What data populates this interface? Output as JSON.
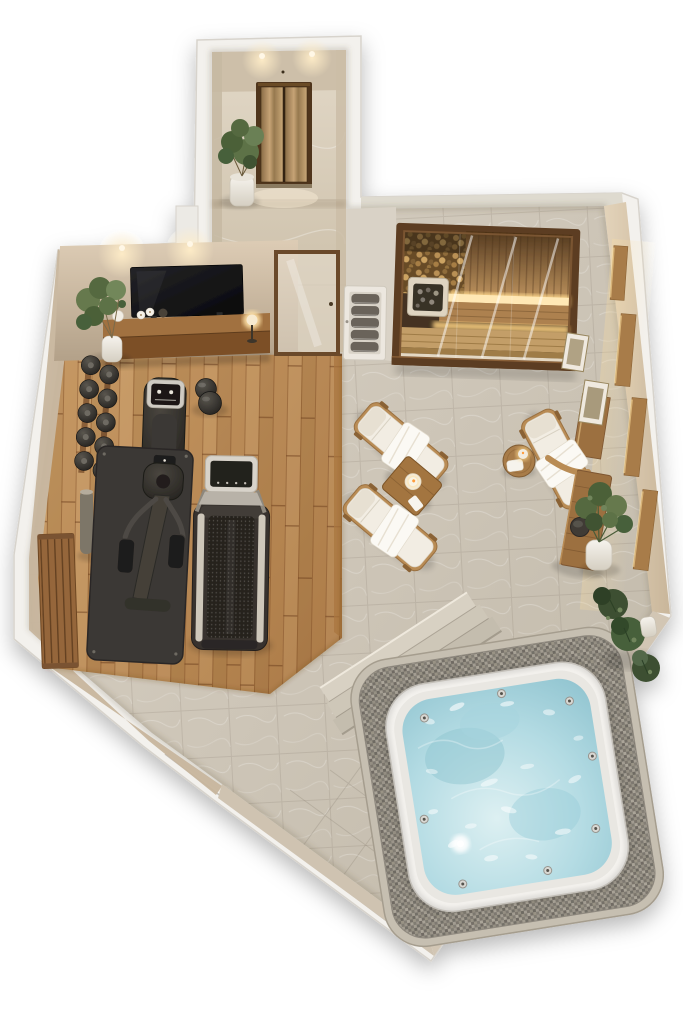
{
  "scene": {
    "label": "3D rendered top-down floor plan of a private wellness suite with gym, sauna, lounge and hot tub",
    "background": "#ffffff",
    "view": "top-down 3D render, no visible text"
  },
  "areas": {
    "lobby": {
      "label": "Elevator lobby"
    },
    "corridor": {
      "label": "Corridor"
    },
    "gym": {
      "label": "Home gym"
    },
    "sauna": {
      "label": "Sauna"
    },
    "hall": {
      "label": "Passage with towel cabinet"
    },
    "lounge": {
      "label": "Relaxation lounge"
    },
    "spa": {
      "label": "Hot tub terrace"
    }
  },
  "objects": {
    "elevator_door": {
      "label": "Bronze elevator door"
    },
    "lobby_plant": {
      "label": "Potted plant"
    },
    "downlights": {
      "label": "Ceiling downlights"
    },
    "tv": {
      "label": "Wall-mounted TV"
    },
    "console": {
      "label": "Floating media console"
    },
    "console_decor": {
      "label": "Vase, candles and table lamp"
    },
    "gym_plant": {
      "label": "Tall plant"
    },
    "dumbbell_rack": {
      "label": "Dumbbell rack"
    },
    "canisters": {
      "label": "Storage cylinders"
    },
    "strength_machine": {
      "label": "Smart strength machine with screen"
    },
    "medicine_balls": {
      "label": "Medicine balls"
    },
    "treadmill": {
      "label": "Treadmill"
    },
    "mat": {
      "label": "Equipment mat"
    },
    "elliptical": {
      "label": "Elliptical trainer"
    },
    "slat_panel": {
      "label": "Wood slat radiator cover"
    },
    "sauna_room": {
      "label": "Glass-front sauna"
    },
    "sauna_heater": {
      "label": "Sauna heater"
    },
    "sauna_benches": {
      "label": "Cedar benches with LED strips"
    },
    "pebble_wall": {
      "label": "Pebble accent wall"
    },
    "towel_cabinet": {
      "label": "Towel cabinet"
    },
    "glass_door": {
      "label": "Glass door"
    },
    "lounger": {
      "label": "Chaise lounger with towel"
    },
    "square_table": {
      "label": "Wooden tray table with candle"
    },
    "round_table": {
      "label": "Round side table with candle"
    },
    "wall_bench": {
      "label": "Wooden wall bench"
    },
    "decor_bowl": {
      "label": "Dark decor bowl"
    },
    "bench_plant": {
      "label": "Potted plant"
    },
    "wall_frames": {
      "label": "Framed art"
    },
    "wall_panels": {
      "label": "Backlit wood wall panels"
    },
    "steps": {
      "label": "Stone steps to spa level"
    },
    "mosaic_deck": {
      "label": "Mosaic tile deck"
    },
    "hot_tub": {
      "label": "Hot tub with jets"
    },
    "spa_plants": {
      "label": "Green shrubs"
    }
  },
  "palette": {
    "wall_white": "#f3f1ed",
    "wall_cut_grey": "#dedacf",
    "stone_floor": "#cfc7b9",
    "marble_floor": "#d9cdb9",
    "wood_floor": "#c2925e",
    "gym_wall": "#c9b79f",
    "sauna_frame": "#5c3c20",
    "sauna_wood": "#8a5f34",
    "sauna_glow": "#ffd98a",
    "water_blue": "#aed8e0",
    "water_deep": "#8cc4cf",
    "mosaic_grey": "#8f897f",
    "equipment_black": "#2c2a27",
    "lounger_white": "#f2ede3",
    "lounger_wood": "#b98c55",
    "plant_green": "#55693f",
    "pot_white": "#efe9e1",
    "bronze_door": "#c6a375",
    "candle_glow": "#ffd27f"
  }
}
